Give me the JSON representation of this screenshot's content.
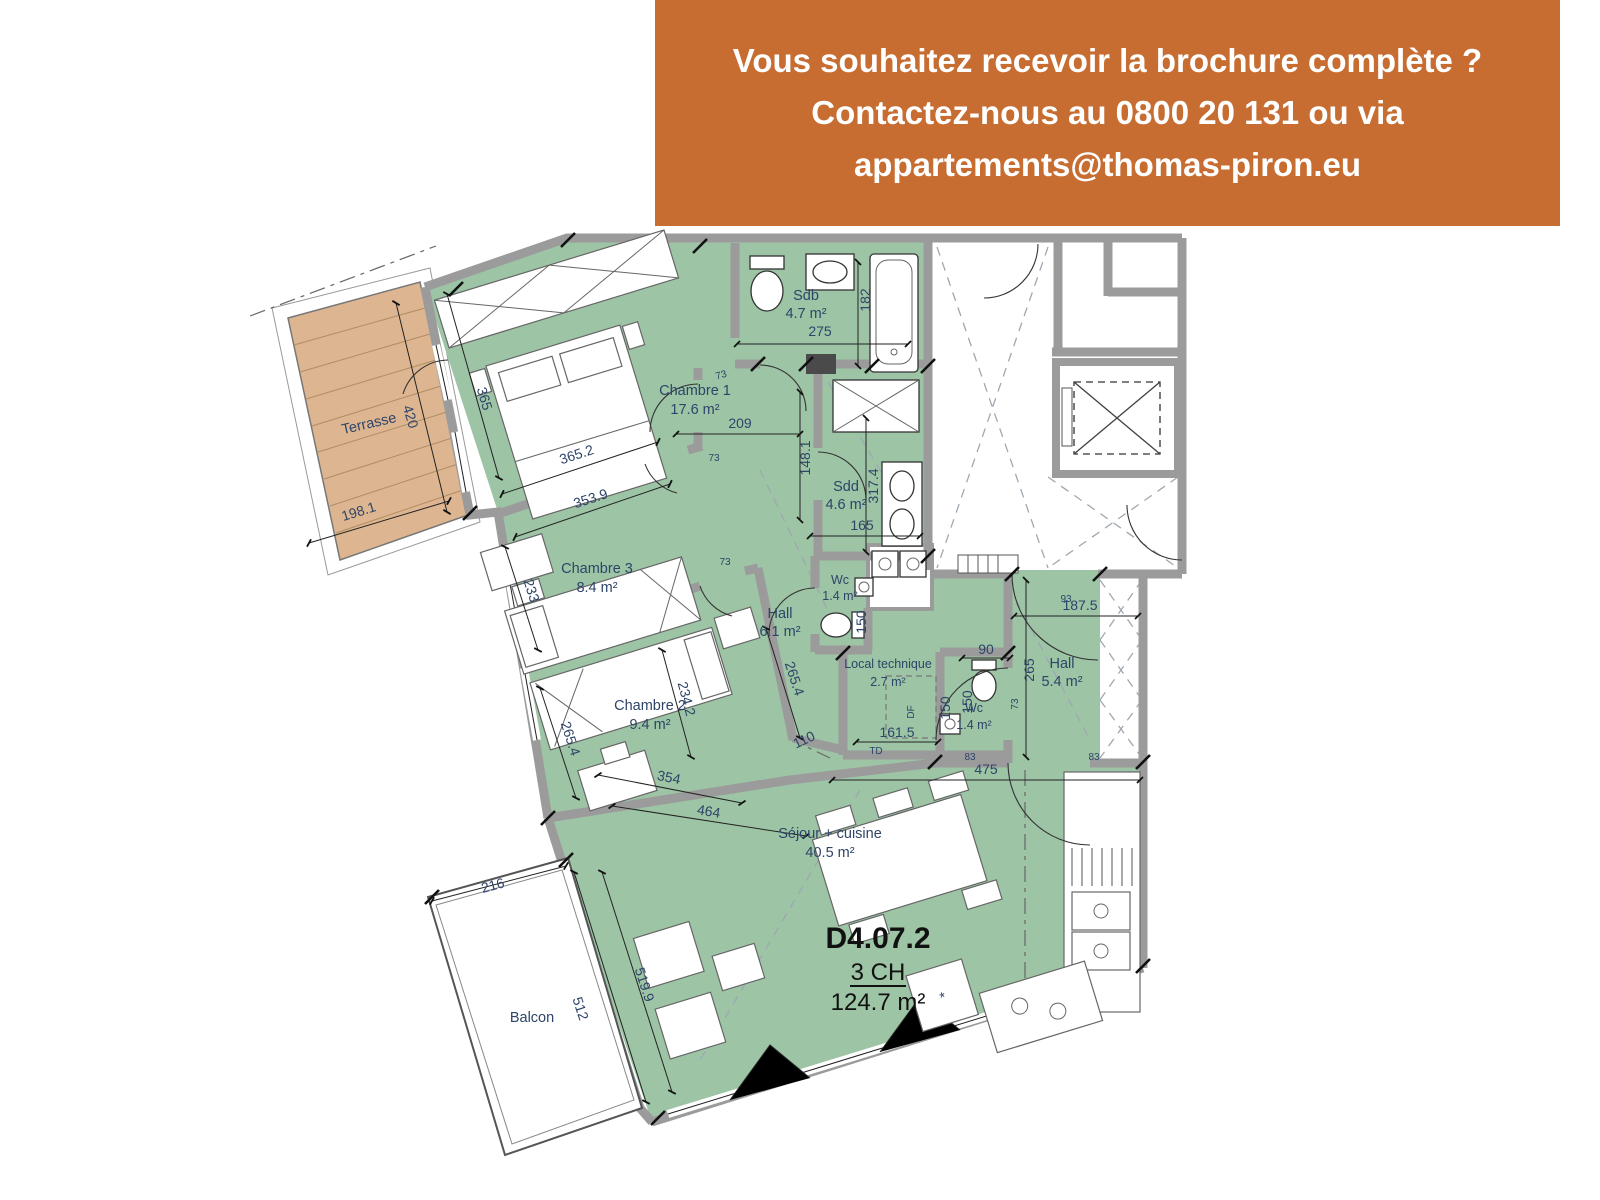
{
  "banner": {
    "line1": "Vous souhaitez recevoir la brochure complète ?",
    "line2": "Contactez-nous au 0800 20 131 ou via",
    "line3": "appartements@thomas-piron.eu",
    "bg_color": "#C76D31",
    "text_color": "#FFFFFF"
  },
  "unit": {
    "code": "D4.07.2",
    "bedrooms": "3 CH",
    "area": "124.7 m²"
  },
  "plan": {
    "rooms": [
      {
        "name": "Chambre 1",
        "area": "17.6 m²"
      },
      {
        "name": "Chambre 3",
        "area": "8.4 m²"
      },
      {
        "name": "Chambre 2",
        "area": "9.4 m²"
      },
      {
        "name": "Sdb",
        "area": "4.7 m²"
      },
      {
        "name": "Sdd",
        "area": "4.6 m²"
      },
      {
        "name": "Wc",
        "area": "1.4 m²"
      },
      {
        "name": "Wc",
        "area": "1.4 m²"
      },
      {
        "name": "Hall",
        "area": "6.1 m²"
      },
      {
        "name": "Hall",
        "area": "5.4 m²"
      },
      {
        "name": "Local technique",
        "area": "2.7 m²"
      },
      {
        "name": "Séjour + cuisine",
        "area": "40.5 m²"
      },
      {
        "name": "Terrasse",
        "area": ""
      },
      {
        "name": "Balcon",
        "area": ""
      }
    ],
    "dims": [
      "420",
      "198.1",
      "365",
      "365.2",
      "353.9",
      "233",
      "209",
      "148.1",
      "275",
      "182",
      "165",
      "317.4",
      "234.2",
      "265.4",
      "265.4",
      "354",
      "464",
      "110",
      "161.5",
      "150",
      "150",
      "150",
      "90",
      "265",
      "187.5",
      "475",
      "216",
      "512",
      "519.9",
      "73",
      "73",
      "73",
      "73",
      "83",
      "83",
      "93",
      "TD",
      "DF",
      "*"
    ],
    "colors": {
      "room_fill": "#9DC4A5",
      "terrace_fill": "#DDB691",
      "wall": "#9B9B9B",
      "label_text": "#2E4468"
    }
  }
}
